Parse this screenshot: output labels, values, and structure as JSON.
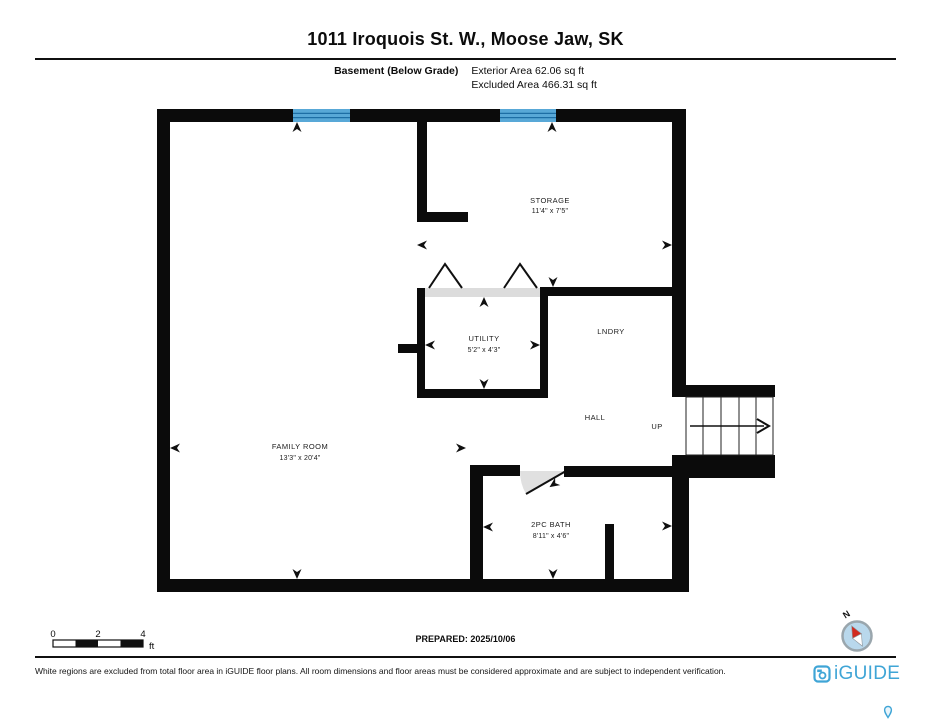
{
  "page": {
    "title": "1011 Iroquois St. W., Moose Jaw, SK",
    "floor_label": "Basement (Below Grade)",
    "exterior_area": "Exterior Area 62.06 sq ft",
    "excluded_area": "Excluded Area 466.31 sq ft",
    "prepared": "PREPARED: 2025/10/06",
    "disclaimer": "White regions are excluded from total floor area in iGUIDE floor plans. All room dimensions and floor areas must be considered approximate and are subject to independent verification.",
    "brand": "iGUIDE"
  },
  "rooms": {
    "storage": {
      "name": "STORAGE",
      "dims": "11'4\" x 7'5\""
    },
    "utility": {
      "name": "UTILITY",
      "dims": "5'2\" x 4'3\""
    },
    "laundry": {
      "name": "LNDRY"
    },
    "hall": {
      "name": "HALL"
    },
    "stairs": {
      "label": "UP"
    },
    "family_room": {
      "name": "FAMILY ROOM",
      "dims": "13'3\" x 20'4\""
    },
    "bath": {
      "name": "2PC BATH",
      "dims": "8'11\" x 4'6\""
    }
  },
  "scale_bar": {
    "ticks": [
      "0",
      "2",
      "4"
    ],
    "unit": "ft"
  },
  "compass": {
    "north": "N"
  },
  "colors": {
    "wall": "#0b0b0b",
    "window_blue": "#58a8d7",
    "window_stripe": "#1d6ea5",
    "opening_gray": "#dcdcdc",
    "brand_blue": "#3fa5d6",
    "compass_red": "#d22b1f",
    "compass_fill": "#b9d8ec"
  }
}
